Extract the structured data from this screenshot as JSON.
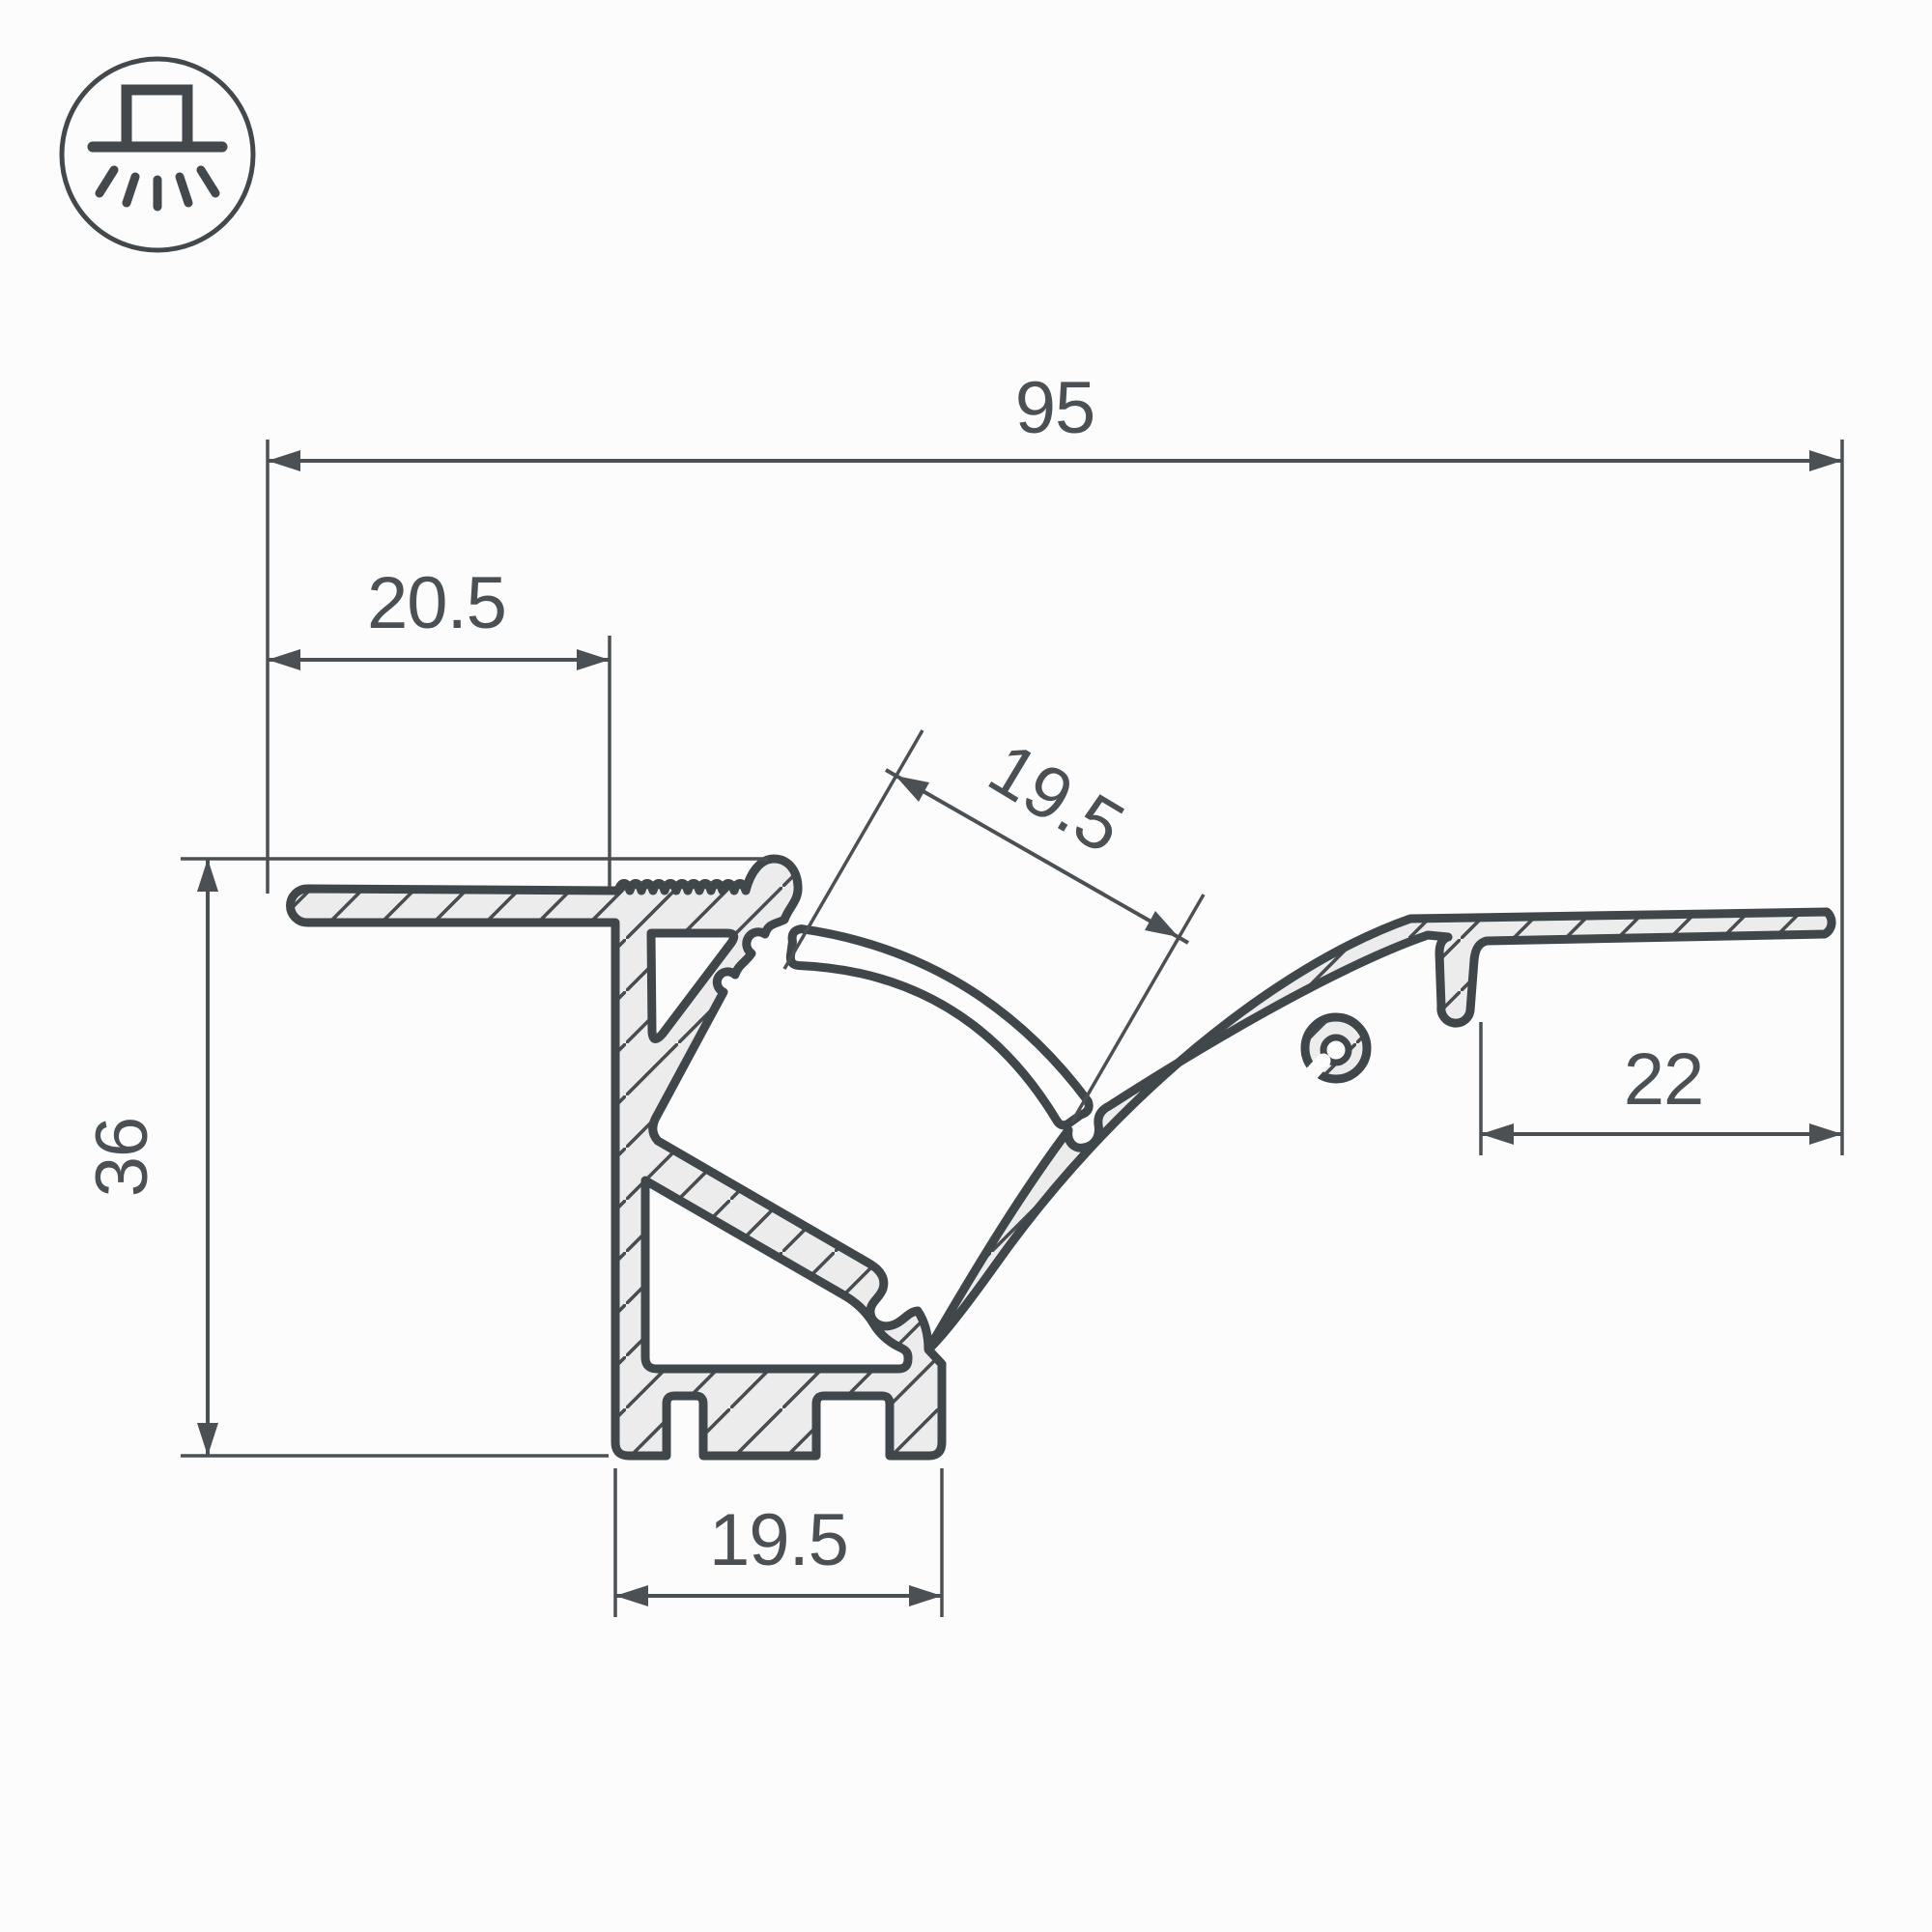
{
  "drawing": {
    "title": "aluminium-led-profile-cross-section",
    "icon": {
      "name": "recessed-light-icon",
      "description": "circle with recessed luminaire glyph and light rays"
    },
    "dimensions": {
      "overall_width": "95",
      "left_overhang": "20.5",
      "channel_width": "19.5",
      "overall_height": "36",
      "right_flange_width": "22",
      "base_width": "19.5"
    },
    "colors": {
      "outline": "#40474b",
      "dimension": "#4a5054",
      "metal_fill": "#ececed",
      "background": "#fcfcfc"
    }
  }
}
